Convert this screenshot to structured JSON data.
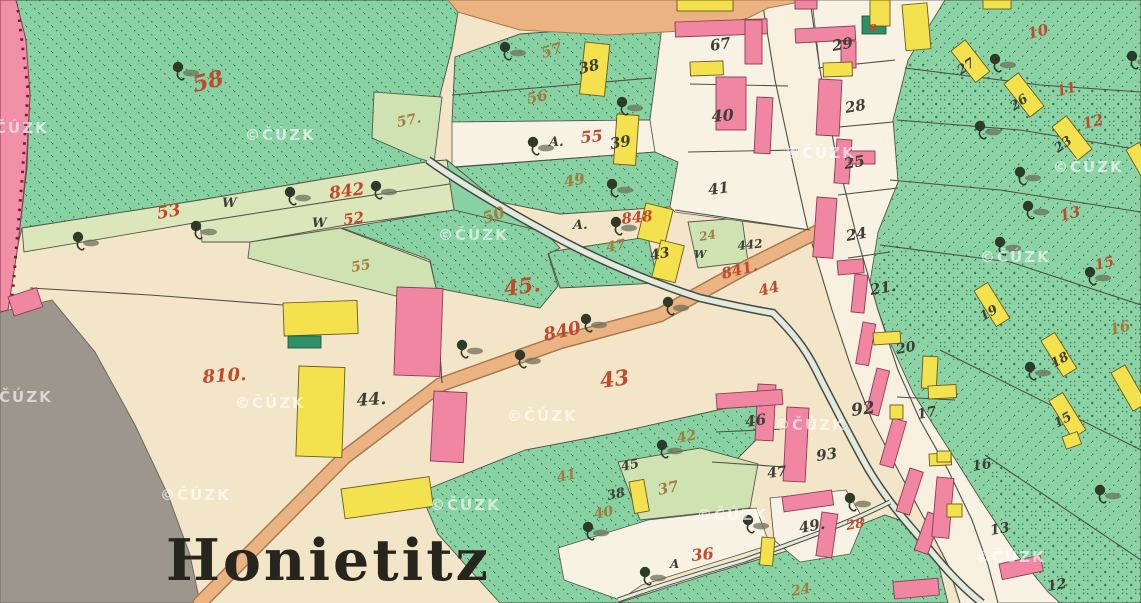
{
  "map": {
    "place_label": "Honietitz",
    "watermark": "©ČÚZK"
  },
  "map_data": {
    "type": "historical-cadastral-map",
    "legend_colors": {
      "masonry_building": "#f086a2",
      "wooden_building": "#f3e24e",
      "meadow_green": "#87d1a2",
      "field_cream": "#f3e6c8",
      "road_tan": "#eab381",
      "water_gray": "#e2eae0",
      "label_red": "#c0492e",
      "label_ochre": "#a37c3f",
      "label_black": "#3e3f37"
    },
    "labels": [
      {
        "t": "58",
        "x": 195,
        "y": 92,
        "c": "r",
        "s": 22,
        "r": -14
      },
      {
        "t": "53",
        "x": 158,
        "y": 219,
        "c": "r",
        "s": 17,
        "r": -10
      },
      {
        "t": "W",
        "x": 222,
        "y": 207,
        "c": "k",
        "s": 13,
        "r": 0
      },
      {
        "t": "842",
        "x": 330,
        "y": 199,
        "c": "r",
        "s": 17,
        "r": -8
      },
      {
        "t": "W",
        "x": 312,
        "y": 227,
        "c": "k",
        "s": 13,
        "r": 0
      },
      {
        "t": "52",
        "x": 344,
        "y": 225,
        "c": "r",
        "s": 15,
        "r": -8
      },
      {
        "t": "55",
        "x": 352,
        "y": 272,
        "c": "o",
        "s": 14,
        "r": -10
      },
      {
        "t": "57.",
        "x": 398,
        "y": 127,
        "c": "o",
        "s": 14,
        "r": -12
      },
      {
        "t": "57",
        "x": 543,
        "y": 58,
        "c": "o",
        "s": 15,
        "r": -16
      },
      {
        "t": "38",
        "x": 580,
        "y": 74,
        "c": "k",
        "s": 15,
        "r": -14
      },
      {
        "t": "56",
        "x": 528,
        "y": 104,
        "c": "o",
        "s": 15,
        "r": -12
      },
      {
        "t": "A.",
        "x": 549,
        "y": 146,
        "c": "k",
        "s": 13,
        "r": 0
      },
      {
        "t": "55",
        "x": 581,
        "y": 143,
        "c": "r",
        "s": 16,
        "r": -5
      },
      {
        "t": "39",
        "x": 611,
        "y": 149,
        "c": "k",
        "s": 15,
        "r": -10
      },
      {
        "t": "67",
        "x": 711,
        "y": 51,
        "c": "k",
        "s": 15,
        "r": -10
      },
      {
        "t": "40",
        "x": 712,
        "y": 122,
        "c": "k",
        "s": 16,
        "r": -5
      },
      {
        "t": "41",
        "x": 709,
        "y": 195,
        "c": "k",
        "s": 15,
        "r": -8
      },
      {
        "t": "49",
        "x": 565,
        "y": 187,
        "c": "o",
        "s": 15,
        "r": -10
      },
      {
        "t": "A.",
        "x": 573,
        "y": 229,
        "c": "k",
        "s": 13,
        "r": 0
      },
      {
        "t": "848",
        "x": 622,
        "y": 224,
        "c": "r",
        "s": 15,
        "r": -6
      },
      {
        "t": "47",
        "x": 607,
        "y": 252,
        "c": "o",
        "s": 14,
        "r": -10
      },
      {
        "t": "43",
        "x": 651,
        "y": 260,
        "c": "k",
        "s": 14,
        "r": -10
      },
      {
        "t": "24",
        "x": 700,
        "y": 241,
        "c": "o",
        "s": 12,
        "r": -10
      },
      {
        "t": "W",
        "x": 694,
        "y": 258,
        "c": "k",
        "s": 11,
        "r": 0
      },
      {
        "t": "442",
        "x": 738,
        "y": 250,
        "c": "k",
        "s": 12,
        "r": -6
      },
      {
        "t": "841.",
        "x": 723,
        "y": 279,
        "c": "r",
        "s": 15,
        "r": -14
      },
      {
        "t": "44",
        "x": 760,
        "y": 296,
        "c": "r",
        "s": 15,
        "r": -14
      },
      {
        "t": "50",
        "x": 485,
        "y": 224,
        "c": "o",
        "s": 16,
        "r": -20
      },
      {
        "t": "45.",
        "x": 505,
        "y": 296,
        "c": "r",
        "s": 21,
        "r": -8
      },
      {
        "t": "840",
        "x": 545,
        "y": 341,
        "c": "r",
        "s": 18,
        "r": -12
      },
      {
        "t": "43",
        "x": 601,
        "y": 388,
        "c": "r",
        "s": 21,
        "r": -8
      },
      {
        "t": "810.",
        "x": 203,
        "y": 383,
        "c": "r",
        "s": 18,
        "r": -4
      },
      {
        "t": "44.",
        "x": 357,
        "y": 406,
        "c": "k",
        "s": 17,
        "r": -4
      },
      {
        "t": "41",
        "x": 558,
        "y": 482,
        "c": "o",
        "s": 14,
        "r": -12
      },
      {
        "t": "42",
        "x": 678,
        "y": 443,
        "c": "o",
        "s": 14,
        "r": -12
      },
      {
        "t": "45",
        "x": 622,
        "y": 471,
        "c": "k",
        "s": 13,
        "r": -12
      },
      {
        "t": "38",
        "x": 608,
        "y": 500,
        "c": "k",
        "s": 13,
        "r": -12
      },
      {
        "t": "40",
        "x": 595,
        "y": 519,
        "c": "o",
        "s": 14,
        "r": -12
      },
      {
        "t": "37",
        "x": 659,
        "y": 495,
        "c": "o",
        "s": 15,
        "r": -12
      },
      {
        "t": "A",
        "x": 670,
        "y": 568,
        "c": "k",
        "s": 12,
        "r": 0
      },
      {
        "t": "36",
        "x": 692,
        "y": 561,
        "c": "r",
        "s": 16,
        "r": -6
      },
      {
        "t": "24",
        "x": 792,
        "y": 596,
        "c": "o",
        "s": 14,
        "r": -10
      },
      {
        "t": "49.",
        "x": 800,
        "y": 533,
        "c": "k",
        "s": 15,
        "r": -10
      },
      {
        "t": "28",
        "x": 847,
        "y": 530,
        "c": "r",
        "s": 13,
        "r": -10
      },
      {
        "t": "46",
        "x": 746,
        "y": 427,
        "c": "k",
        "s": 15,
        "r": -8
      },
      {
        "t": "93",
        "x": 817,
        "y": 461,
        "c": "k",
        "s": 15,
        "r": -8
      },
      {
        "t": "47",
        "x": 768,
        "y": 478,
        "c": "k",
        "s": 14,
        "r": -8
      },
      {
        "t": "92",
        "x": 852,
        "y": 416,
        "c": "k",
        "s": 17,
        "r": -8
      },
      {
        "t": "20",
        "x": 897,
        "y": 354,
        "c": "k",
        "s": 14,
        "r": -10
      },
      {
        "t": "17",
        "x": 918,
        "y": 419,
        "c": "k",
        "s": 14,
        "r": -10
      },
      {
        "t": "16",
        "x": 973,
        "y": 471,
        "c": "k",
        "s": 14,
        "r": -10
      },
      {
        "t": "13",
        "x": 991,
        "y": 535,
        "c": "k",
        "s": 14,
        "r": -10
      },
      {
        "t": "12",
        "x": 1048,
        "y": 591,
        "c": "k",
        "s": 14,
        "r": -10
      },
      {
        "t": "29",
        "x": 833,
        "y": 51,
        "c": "k",
        "s": 15,
        "r": -10
      },
      {
        "t": "28",
        "x": 846,
        "y": 113,
        "c": "k",
        "s": 15,
        "r": -10
      },
      {
        "t": "25",
        "x": 845,
        "y": 169,
        "c": "k",
        "s": 15,
        "r": -10
      },
      {
        "t": "24",
        "x": 847,
        "y": 241,
        "c": "k",
        "s": 15,
        "r": -10
      },
      {
        "t": "21.",
        "x": 871,
        "y": 295,
        "c": "k",
        "s": 15,
        "r": -10
      },
      {
        "t": "27",
        "x": 961,
        "y": 75,
        "c": "k",
        "s": 13,
        "r": -35
      },
      {
        "t": "26",
        "x": 1014,
        "y": 111,
        "c": "k",
        "s": 13,
        "r": -35
      },
      {
        "t": "23",
        "x": 1058,
        "y": 153,
        "c": "k",
        "s": 13,
        "r": -35
      },
      {
        "t": "19",
        "x": 983,
        "y": 321,
        "c": "k",
        "s": 13,
        "r": -30
      },
      {
        "t": "18",
        "x": 1054,
        "y": 368,
        "c": "k",
        "s": 13,
        "r": -30
      },
      {
        "t": "15",
        "x": 1057,
        "y": 428,
        "c": "k",
        "s": 13,
        "r": -30
      },
      {
        "t": "10",
        "x": 1029,
        "y": 39,
        "c": "r",
        "s": 15,
        "r": -14
      },
      {
        "t": "11",
        "x": 1058,
        "y": 96,
        "c": "r",
        "s": 14,
        "r": -14
      },
      {
        "t": "12",
        "x": 1084,
        "y": 129,
        "c": "r",
        "s": 15,
        "r": -14
      },
      {
        "t": "13",
        "x": 1061,
        "y": 221,
        "c": "r",
        "s": 15,
        "r": -14
      },
      {
        "t": "15",
        "x": 1096,
        "y": 270,
        "c": "r",
        "s": 14,
        "r": -14
      },
      {
        "t": "16",
        "x": 1111,
        "y": 335,
        "c": "o",
        "s": 15,
        "r": -14
      },
      {
        "t": "8",
        "x": 869,
        "y": 32,
        "c": "r",
        "s": 11,
        "r": 0
      }
    ],
    "watermarks": [
      {
        "x": -22,
        "y": 133
      },
      {
        "x": 245,
        "y": 140
      },
      {
        "x": 785,
        "y": 158
      },
      {
        "x": 1053,
        "y": 172
      },
      {
        "x": 438,
        "y": 240
      },
      {
        "x": 980,
        "y": 262
      },
      {
        "x": 235,
        "y": 408
      },
      {
        "x": -18,
        "y": 402
      },
      {
        "x": 160,
        "y": 500
      },
      {
        "x": 507,
        "y": 421
      },
      {
        "x": 430,
        "y": 510
      },
      {
        "x": 775,
        "y": 430
      },
      {
        "x": 697,
        "y": 520
      },
      {
        "x": 975,
        "y": 562
      }
    ]
  }
}
